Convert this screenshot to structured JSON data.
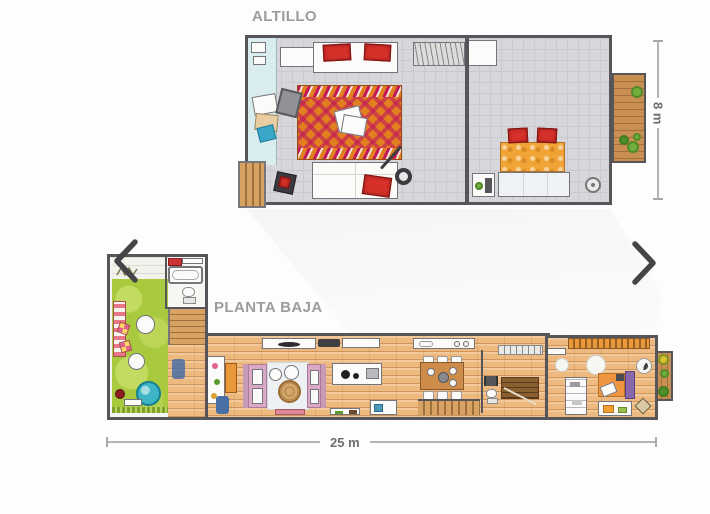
{
  "altillo": {
    "title": "ALTILLO",
    "dimension_label": "8 m",
    "rooms": [
      "living-loft",
      "bedroom-loft",
      "balcony"
    ]
  },
  "planta_baja": {
    "title": "PLANTA BAJA",
    "dimension_label": "25 m",
    "rooms": [
      "garden-patio",
      "bathroom",
      "living-room",
      "kitchen",
      "dining",
      "stairs",
      "bedroom",
      "balcony"
    ]
  },
  "navigation": {
    "previous_icon": "chevron-left",
    "next_icon": "chevron-right"
  },
  "colors": {
    "title_text": "#9c9c9a",
    "dimension_text": "#6e6e6c",
    "wall": "#56565a",
    "loft_floor": "#d7d7db",
    "wood_floor": "#edb97e",
    "garden_green": "#a9c93e",
    "rug_orange": "#e2801f",
    "rug_magenta": "#c2185b",
    "accent_red": "#d5302a",
    "bed_orange": "#f0a435",
    "balcony_wood": "#c98f52",
    "pool_teal": "#3db4c5"
  }
}
